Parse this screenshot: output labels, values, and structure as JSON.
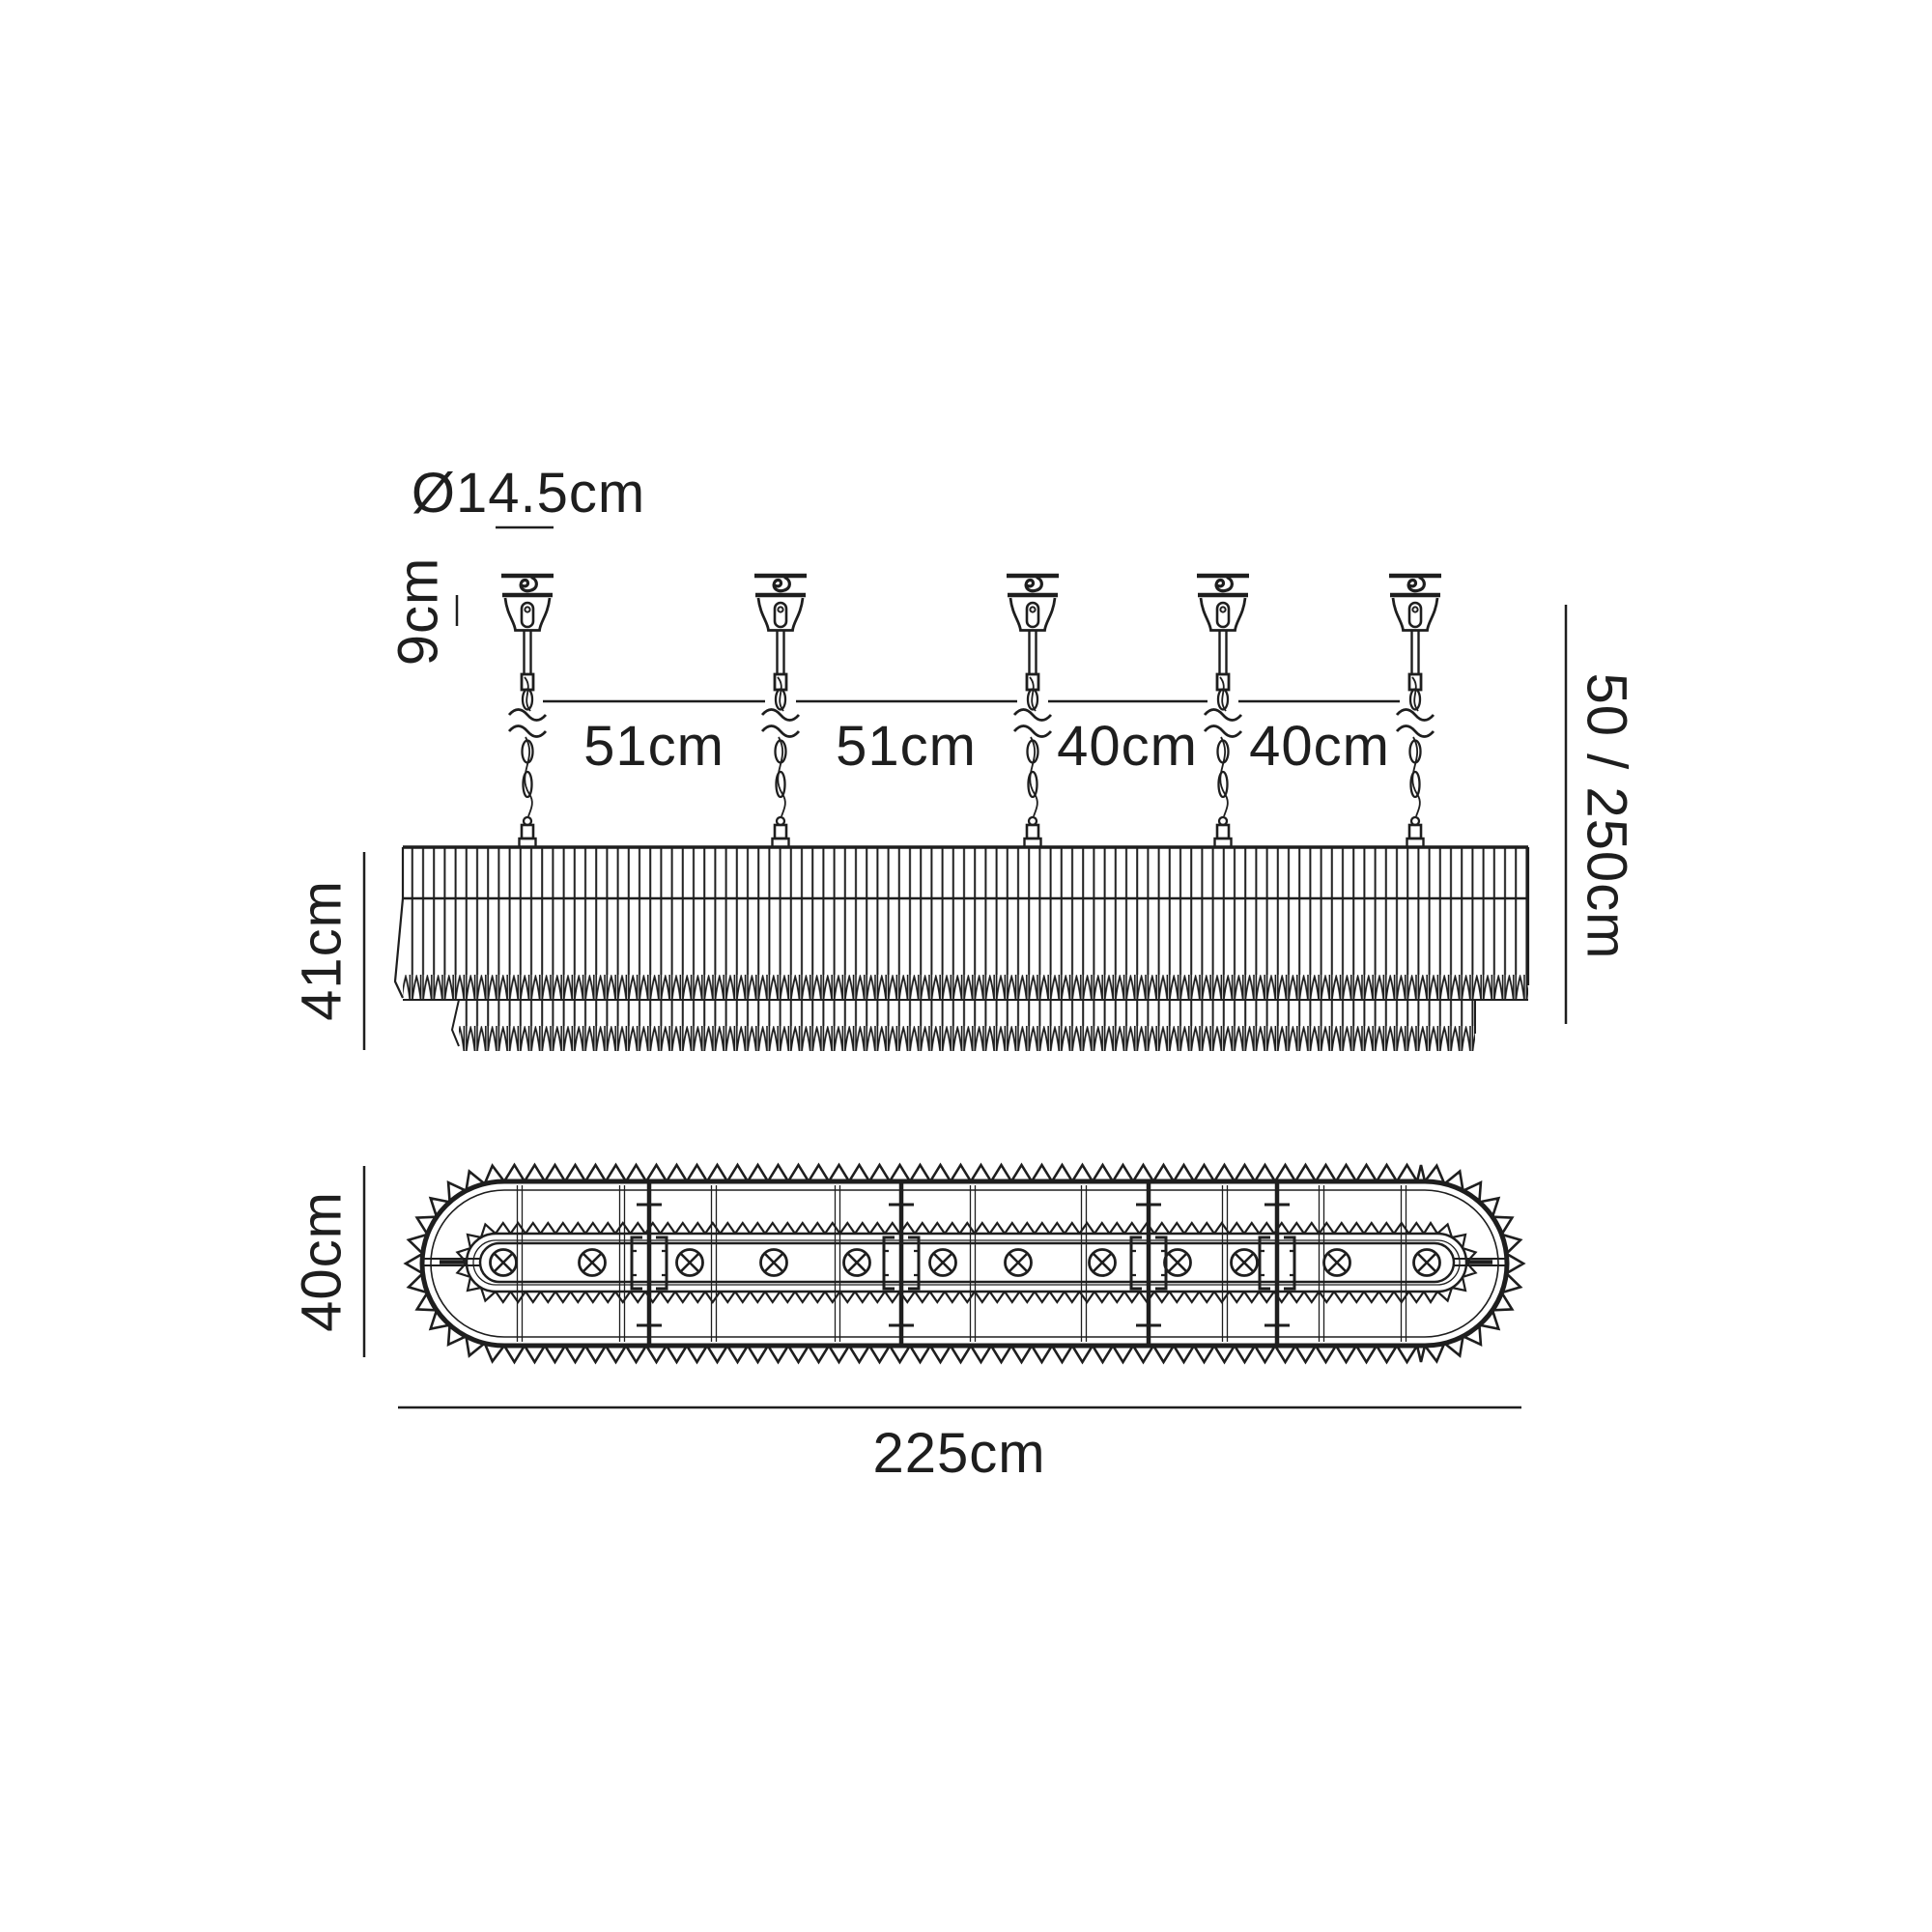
{
  "meta": {
    "diagram_type": "technical dimension drawing",
    "subject": "linear oval crystal chandelier, side elevation and plan view",
    "background_color": "#ffffff",
    "line_color": "#1e1e1e",
    "suspension_count": 5,
    "lamp_count": 12,
    "lamp_symbol": "circled-x-lamp-position"
  },
  "labels": {
    "canopy_diameter": "Ø14.5cm",
    "canopy_height": "9cm",
    "spacing_a": "51cm",
    "spacing_b": "51cm",
    "spacing_c": "40cm",
    "spacing_d": "40cm",
    "drop_height": "50 / 250cm",
    "body_height": "41cm",
    "plan_width": "40cm",
    "plan_length": "225cm"
  }
}
